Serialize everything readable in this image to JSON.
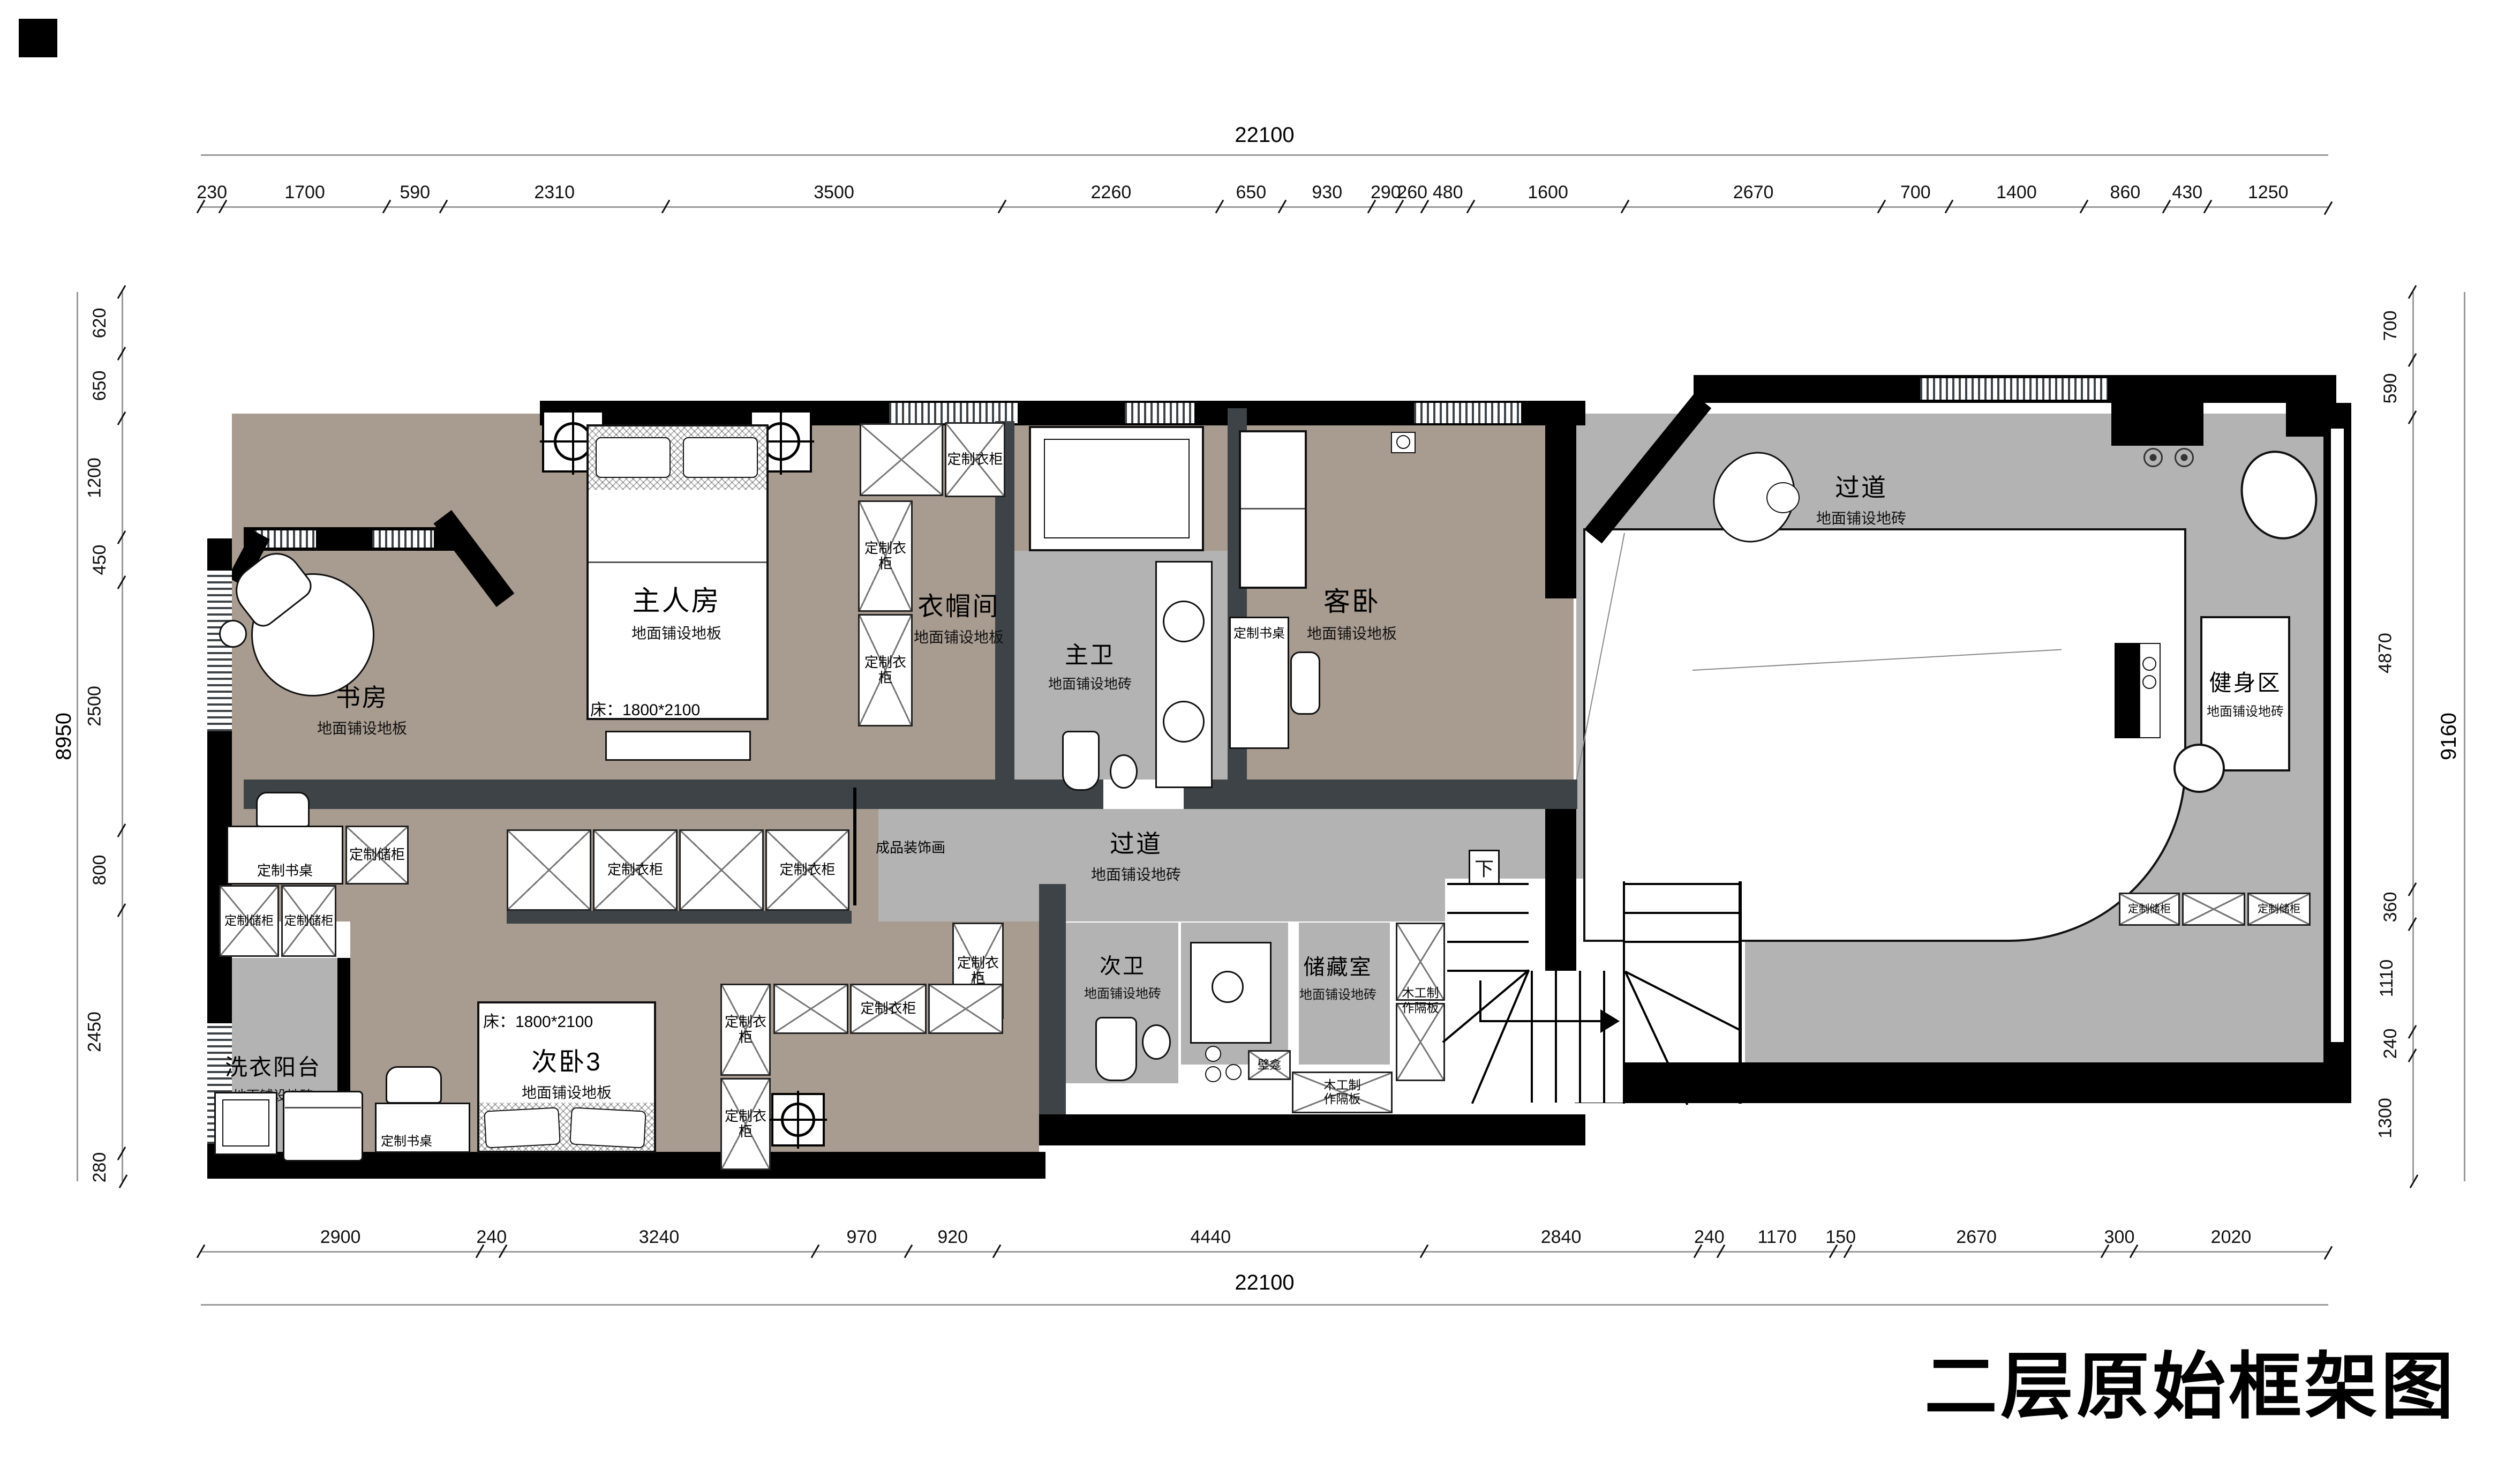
{
  "title": "二层原始框架图",
  "colors": {
    "wood_floor": "#a89b90",
    "tile_floor": "#b3b3b3",
    "wall_dark": "#3d4347",
    "wall_black": "#000000",
    "dim_line": "#9a9a9a"
  },
  "dims": {
    "top": {
      "total": 22100,
      "segments": [
        230,
        1700,
        590,
        2310,
        3500,
        2260,
        650,
        930,
        290,
        260,
        480,
        1600,
        2670,
        700,
        1400,
        860,
        430,
        1250
      ]
    },
    "bottom": {
      "total": 22100,
      "segments": [
        2900,
        240,
        3240,
        970,
        920,
        4440,
        2840,
        240,
        1170,
        150,
        2670,
        300,
        2020
      ]
    },
    "left": {
      "total": 8950,
      "segments": [
        620,
        650,
        1200,
        450,
        2500,
        800,
        2450,
        280
      ]
    },
    "right": {
      "total": 9160,
      "segments": [
        700,
        590,
        4870,
        360,
        1110,
        240,
        1300
      ]
    }
  },
  "rooms": {
    "study": {
      "name": "书房",
      "floor": "地面铺设地板"
    },
    "master": {
      "name": "主人房",
      "floor": "地面铺设地板",
      "bed": "床：1800*2100"
    },
    "cloak": {
      "name": "衣帽间",
      "floor": "地面铺设地板"
    },
    "master_bath": {
      "name": "主卫",
      "floor": "地面铺设地砖"
    },
    "guest": {
      "name": "客卧",
      "floor": "地面铺设地板"
    },
    "corridor_top": {
      "name": "过道",
      "floor": "地面铺设地砖"
    },
    "gym": {
      "name": "健身区",
      "floor": "地面铺设地砖"
    },
    "corridor_mid": {
      "name": "过道",
      "floor": "地面铺设地砖"
    },
    "second_bath": {
      "name": "次卫",
      "floor": "地面铺设地砖"
    },
    "storage_room": {
      "name": "储藏室",
      "floor": "地面铺设地砖"
    },
    "laundry": {
      "name": "洗衣阳台",
      "floor": "地面铺设地砖"
    },
    "bed3": {
      "name": "次卧3",
      "floor": "地面铺设地板",
      "bed": "床：1800*2100"
    }
  },
  "labels": {
    "wardrobe": "定制衣柜",
    "storage_cabinet": "定制储柜",
    "desk": "定制书桌",
    "art": "成品装饰画",
    "niche": "壁龛",
    "partition": "木工制作隔板",
    "stairs_down": "下"
  }
}
